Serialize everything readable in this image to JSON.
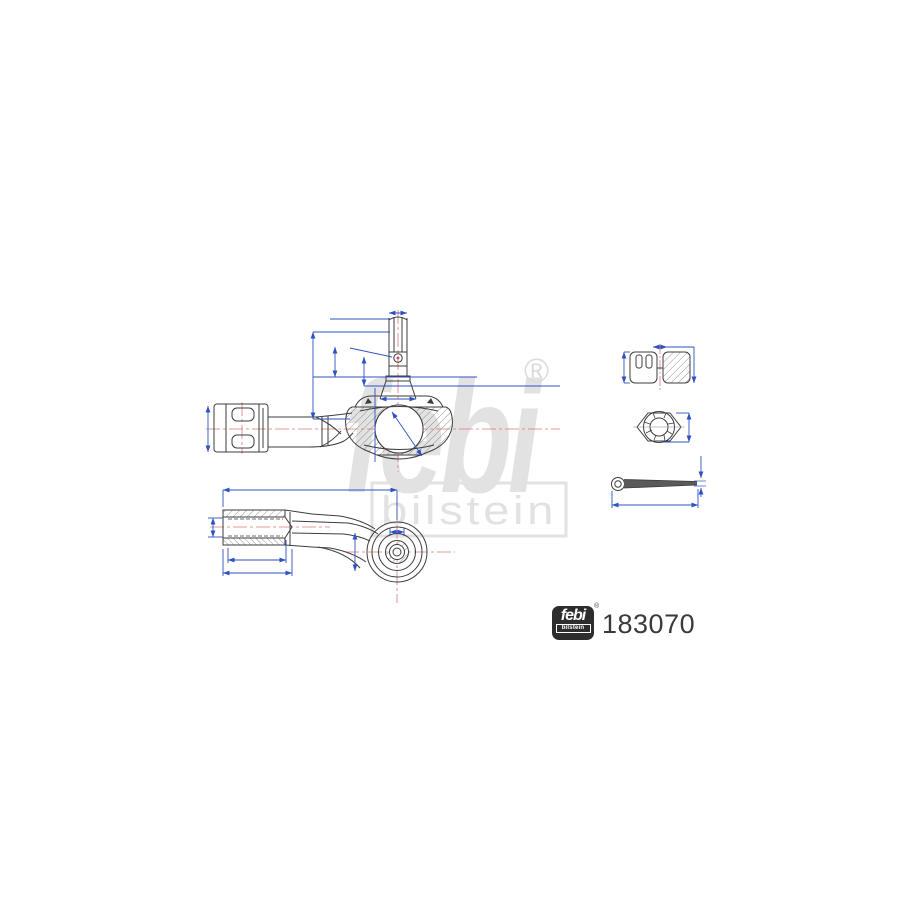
{
  "product": {
    "part_number": "183070",
    "brand_script": "febi",
    "brand_sub": "bilstein",
    "registered_mark": "®"
  },
  "watermark": {
    "script": "febi",
    "sub": "bilstein",
    "registered_mark": "®",
    "color": "#e2e2e2"
  },
  "logo_badge": {
    "script": "febi",
    "sub": "bilstein",
    "registered_mark": "®",
    "background": "#2d2d2d"
  },
  "drawing": {
    "subject": "tie-rod-end technical line drawing",
    "views": [
      {
        "id": "side-view",
        "description": "side elevation with threaded ball stud, castellation cross hole, dust-boot housing, ball joint and inner socket arm"
      },
      {
        "id": "plan-view",
        "description": "top view with internally threaded tube (section hatch) and concentric ball-housing circles"
      }
    ],
    "accessories": [
      {
        "id": "castle-nut-section",
        "description": "castellated nut, sectional view"
      },
      {
        "id": "castle-nut-top",
        "description": "castellated nut, top view"
      },
      {
        "id": "cotter-pin",
        "description": "split cotter pin, side view"
      }
    ],
    "colors": {
      "outline": "#3d3d3d",
      "dimension_blue": "#2f52c3",
      "centerline_red": "#cc4a4a",
      "hatch_gray": "#6a6a6a",
      "background": "#ffffff"
    }
  }
}
